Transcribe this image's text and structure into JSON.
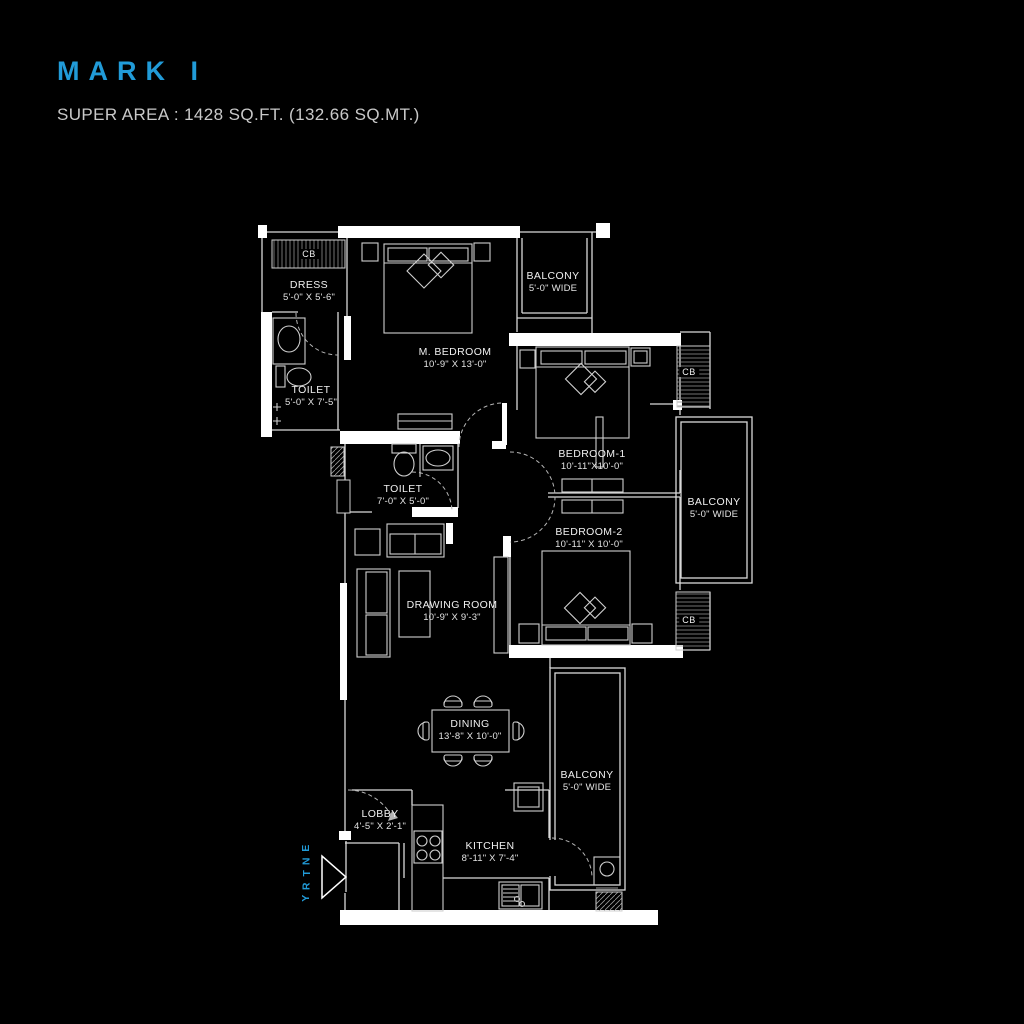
{
  "header": {
    "title": "MARK I",
    "subtitle": "SUPER AREA : 1428 SQ.FT. (132.66 SQ.MT.)"
  },
  "colors": {
    "accent": "#219bd8",
    "line": "#d9d9d9",
    "wall": "#ffffff",
    "background": "#000000"
  },
  "entry": {
    "label": "ENTRY"
  },
  "cupboard": {
    "label": "CB"
  },
  "rooms": {
    "dress": {
      "name": "DRESS",
      "dims": "5'-0\" X 5'-6\""
    },
    "toilet1": {
      "name": "TOILET",
      "dims": "5'-0\" X 7'-5\""
    },
    "master_bedroom": {
      "name": "M. BEDROOM",
      "dims": "10'-9\" X 13'-0\""
    },
    "balcony_top": {
      "name": "BALCONY",
      "dims": "5'-0\" WIDE"
    },
    "bedroom1": {
      "name": "BEDROOM-1",
      "dims": "10'-11\"X10'-0\""
    },
    "toilet2": {
      "name": "TOILET",
      "dims": "7'-0\" X 5'-0\""
    },
    "balcony_right": {
      "name": "BALCONY",
      "dims": "5'-0\" WIDE"
    },
    "bedroom2": {
      "name": "BEDROOM-2",
      "dims": "10'-11\" X 10'-0\""
    },
    "drawing_room": {
      "name": "DRAWING ROOM",
      "dims": "10'-9\" X 9'-3\""
    },
    "dining": {
      "name": "DINING",
      "dims": "13'-8\" X 10'-0\""
    },
    "balcony_bottom": {
      "name": "BALCONY",
      "dims": "5'-0\" WIDE"
    },
    "lobby": {
      "name": "LOBBY",
      "dims": "4'-5\" X 2'-1\""
    },
    "kitchen": {
      "name": "KITCHEN",
      "dims": "8'-11\" X 7'-4\""
    }
  }
}
